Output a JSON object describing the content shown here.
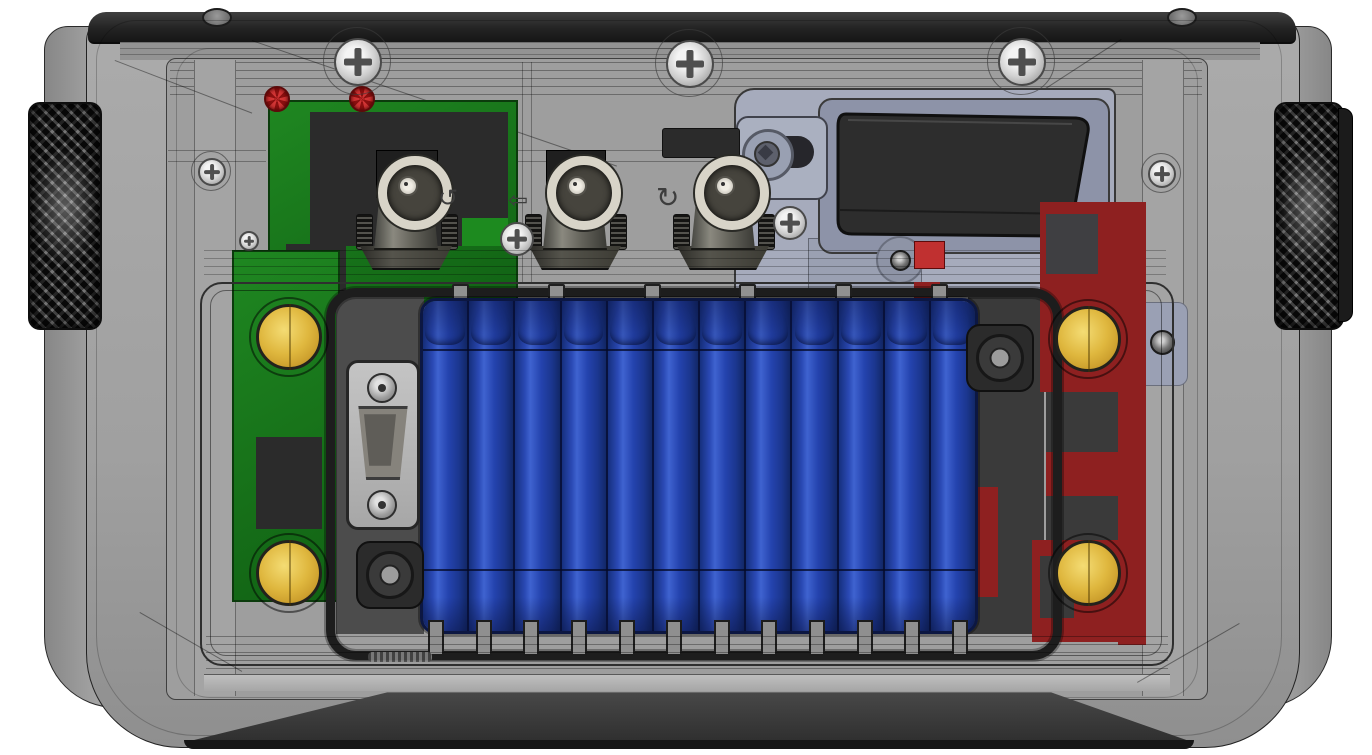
{
  "palette": {
    "background": "#ffffff",
    "housing_gray": "#a5a5a5",
    "panel_gray": "#9e9e9e",
    "top_band": "#232323",
    "bottom_band": "#2f2f2f",
    "knob_black": "#2f2f2f",
    "pcb_green": "#1f8721",
    "pcb_green_dark": "#116214",
    "pcb_red": "#8e2020",
    "pcb_red_bright": "#c03030",
    "component_dark": "#2b2b2b",
    "battery_blue": "#2443ae",
    "battery_blue_dark": "#16307e",
    "battery_blue_light": "#3f63d0",
    "brass_gold": "#dfb73e",
    "brass_gold_light": "#f4dc74",
    "brass_gold_dark": "#9d7a1d",
    "plate_blue_gray": "#a6abbc",
    "window_black": "#2d2d2d",
    "metal_ring": "#d8d4c8",
    "led_red": "#c32222"
  },
  "counts": {
    "side_knobs": 2,
    "top_screws": 3,
    "bnc_connectors": 3,
    "battery_cells": 12,
    "battery_seams": 2,
    "gold_standoffs": 4,
    "rubber_grommets": 2,
    "indicator_leds": 2,
    "top_posts": 6,
    "bottom_tabs": 12
  },
  "glyphs": {
    "rotate_ccw_arrow": "↺",
    "left_white_arrow": "⇦",
    "rotate_cw_arrow": "↻"
  }
}
